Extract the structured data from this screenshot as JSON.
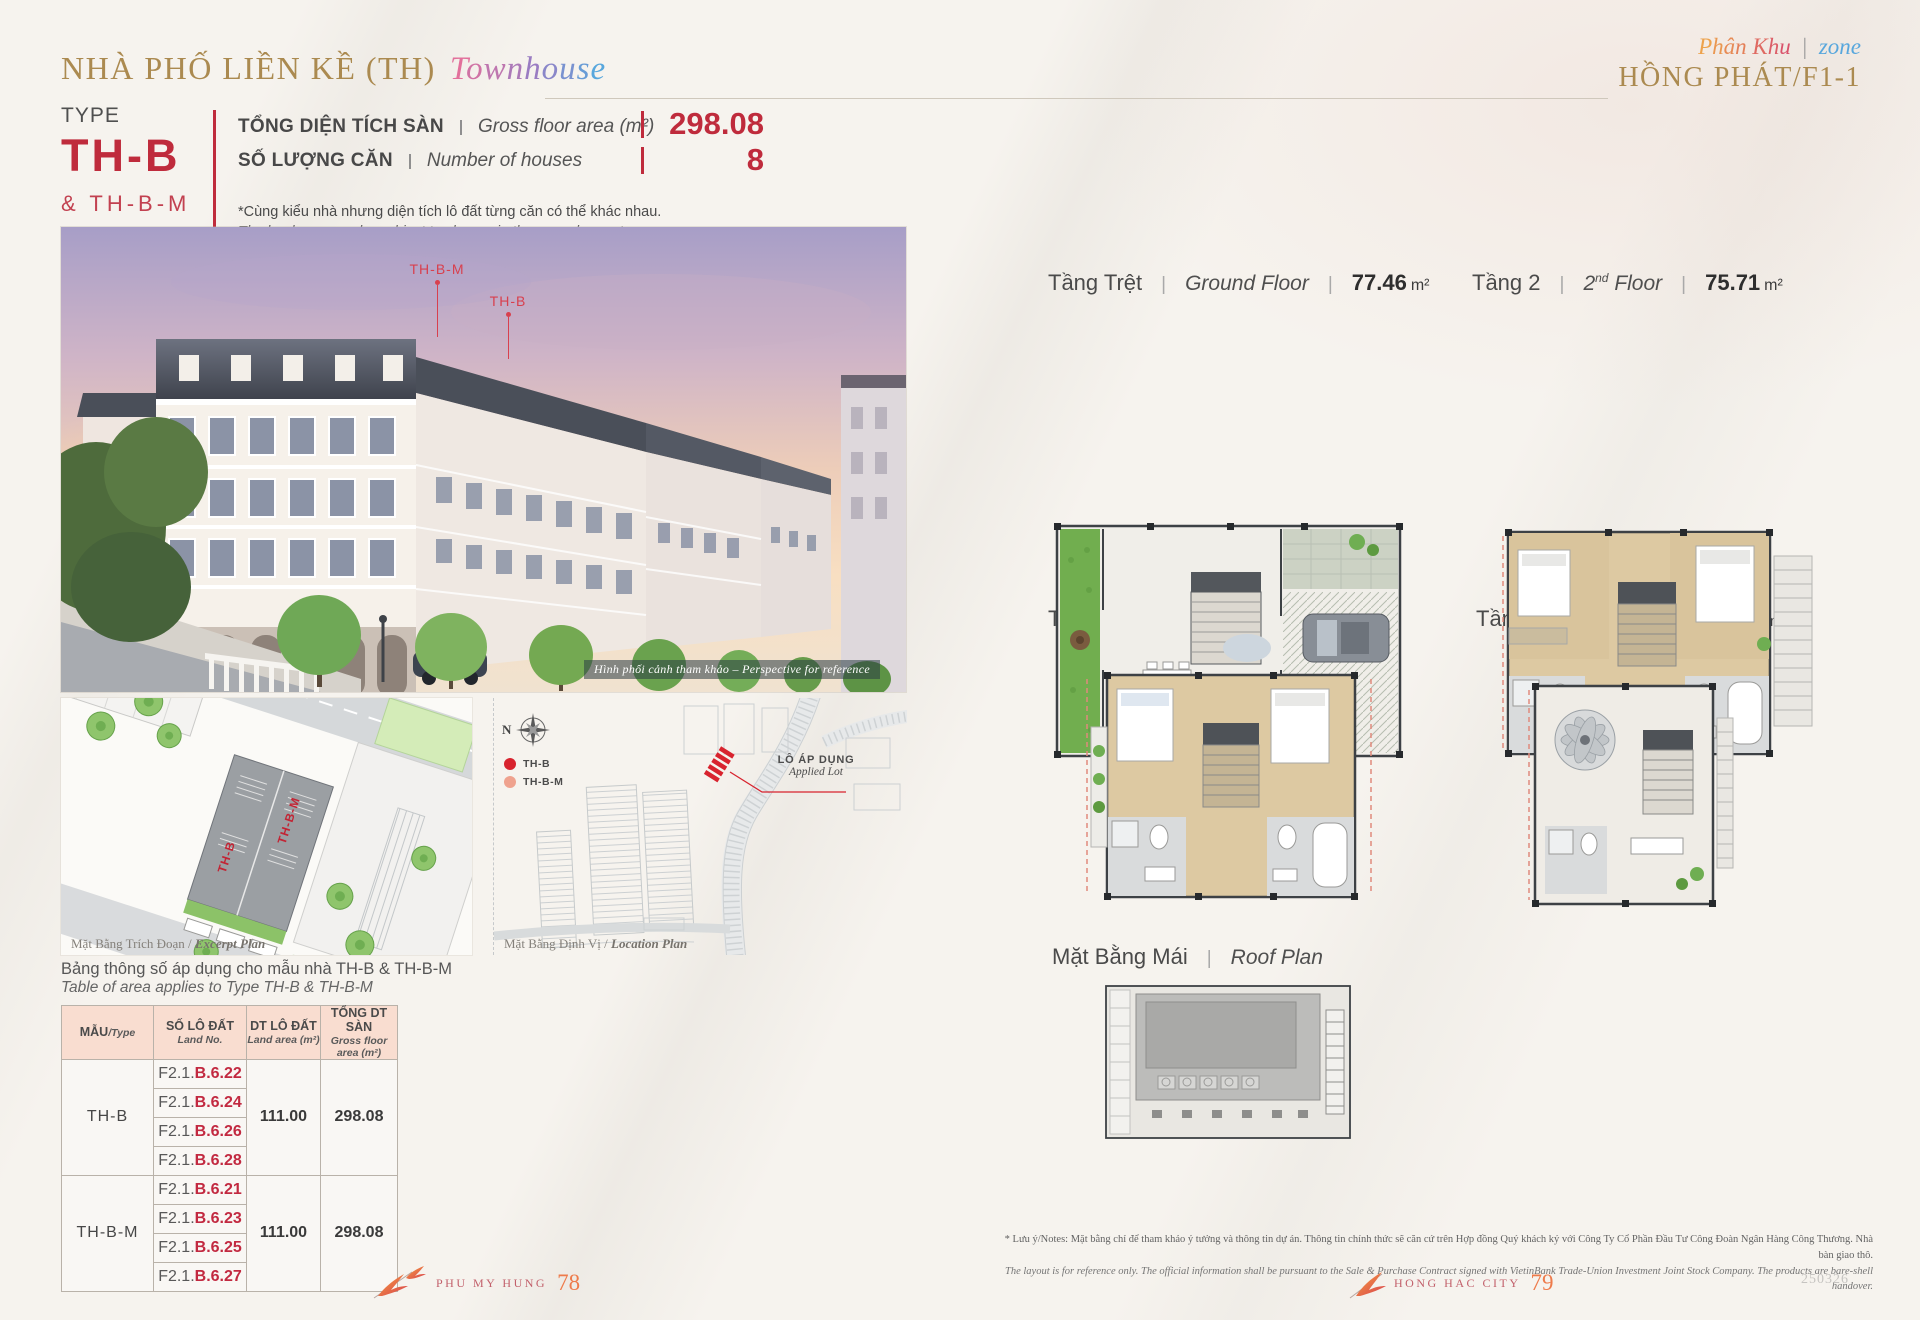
{
  "header": {
    "title": "NHÀ PHỐ LIỀN KỀ (TH)",
    "title_script": "Townhouse",
    "zone_script": "Phân Khu",
    "zone_sep": "|",
    "zone_word": "zone",
    "zone_name": "HỒNG PHÁT/F1-1"
  },
  "type_block": {
    "type_label": "TYPE",
    "type_code": "TH-B",
    "type_alt": "& TH-B-M",
    "specs": [
      {
        "vi": "TỔNG DIỆN TÍCH SÀN",
        "en": "Gross floor area (m²)",
        "value": "298.08"
      },
      {
        "vi": "SỐ LƯỢNG CĂN",
        "en": "Number of houses",
        "value": "8"
      }
    ],
    "note_vi": "*Cùng kiểu nhà nhưng diện tích lô đất từng căn có thể khác nhau.",
    "note_en": "The land area maybe subject to change in the same house type."
  },
  "perspective": {
    "marker_left": "TH-B-M",
    "marker_right": "TH-B",
    "caption": "Hình phối cảnh tham khảo – Perspective for reference"
  },
  "excerpt_plan": {
    "caption_vi": "Mặt Bằng Trích Đoạn",
    "caption_en": "Excerpt Plan",
    "building_label_upper": "TH-B-M",
    "building_label_lower": "TH-B"
  },
  "location_plan": {
    "compass": "N",
    "legend": [
      {
        "label": "TH-B",
        "color": "#d8232e"
      },
      {
        "label": "TH-B-M",
        "color": "#efa28e"
      }
    ],
    "applied_lot_vi": "LÔ ÁP DỤNG",
    "applied_lot_en": "Applied Lot",
    "caption_vi": "Mặt Bằng Định Vị",
    "caption_en": "Location Plan"
  },
  "area_table": {
    "caption_vi": "Bảng thông số áp dụng cho mẫu nhà TH-B & TH-B-M",
    "caption_en": "Table of area applies to Type TH-B & TH-B-M",
    "headers": [
      {
        "vi": "MẪU",
        "en": "/Type"
      },
      {
        "vi": "SỐ LÔ ĐẤT",
        "en": "Land No."
      },
      {
        "vi": "DT LÔ ĐẤT",
        "en": "Land area (m²)"
      },
      {
        "vi": "TỔNG DT SÀN",
        "en": "Gross floor area (m²)"
      }
    ],
    "groups": [
      {
        "type": "TH-B",
        "lot_prefix": "F2.1.",
        "lots": [
          "B.6.22",
          "B.6.24",
          "B.6.26",
          "B.6.28"
        ],
        "land_area": "111.00",
        "gross_area": "298.08"
      },
      {
        "type": "TH-B-M",
        "lot_prefix": "F2.1.",
        "lots": [
          "B.6.21",
          "B.6.23",
          "B.6.25",
          "B.6.27"
        ],
        "land_area": "111.00",
        "gross_area": "298.08"
      }
    ]
  },
  "floor_plans": [
    {
      "vi": "Tầng Trệt",
      "en": "Ground Floor",
      "en_sup": "",
      "en_tail": "",
      "area": "77.46",
      "unit": "m²"
    },
    {
      "vi": "Tầng 2",
      "en": "2",
      "en_sup": "nd",
      "en_tail": " Floor",
      "area": "75.71",
      "unit": "m²"
    },
    {
      "vi": "Tầng 3",
      "en": "3",
      "en_sup": "rd",
      "en_tail": " Floor",
      "area": "75.27",
      "unit": "m²"
    },
    {
      "vi": "Tầng 4",
      "en": "4",
      "en_sup": "th",
      "en_tail": " Floor",
      "area": "69.64",
      "unit": "m²"
    }
  ],
  "roof_plan": {
    "vi": "Mặt Bằng Mái",
    "en": "Roof Plan"
  },
  "footnote": {
    "vi": "* Lưu ý/Notes: Mặt bằng chỉ để tham khảo ý tưởng và thông tin dự án. Thông tin chính thức sẽ căn cứ trên Hợp đồng Quý khách ký với Công Ty Cổ Phần Đầu Tư Công Đoàn Ngân Hàng Công Thương. Nhà bàn giao thô.",
    "en": "The layout is for reference only. The official information shall be pursuant to the Sale & Purchase Contract signed with VietinBank Trade-Union Investment Joint Stock Company. The products are bare-shell handover."
  },
  "footer": {
    "left_brand": "PHU MY HUNG",
    "left_page": "78",
    "right_brand": "HONG HAC CITY",
    "right_page": "79",
    "doc_code": "250326"
  },
  "colors": {
    "brand_red": "#bf2b3c",
    "gold": "#ab8a50",
    "peach_header": "#f9ddd0",
    "accent_blue": "#58a7dd"
  }
}
